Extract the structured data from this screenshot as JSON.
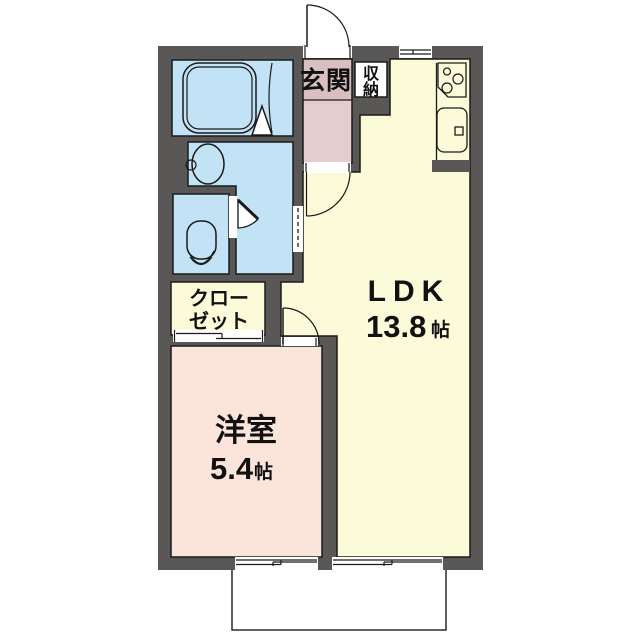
{
  "floorplan": {
    "type": "japanese-apartment-floorplan",
    "wall_color": "#5a5757",
    "outline_color": "#1b1b1b",
    "rooms": {
      "ldk": {
        "label": "LDK",
        "area_value": "13.8",
        "area_unit": "帖",
        "color": "#fbfad9"
      },
      "western_room": {
        "label": "洋室",
        "area_value": "5.4",
        "area_unit": "帖",
        "color": "#fbe5da"
      },
      "closet": {
        "lines": [
          "クロー",
          "ゼット"
        ],
        "color": "#fbfad9"
      },
      "genkan": {
        "label": "玄関",
        "color_upper": "#d9bfc0",
        "color_lower": "#e3cdcd"
      },
      "storage": {
        "chars": [
          "収",
          "納"
        ],
        "color": "#ffffff"
      },
      "bathroom": {
        "color": "#c2e2f6"
      },
      "washroom": {
        "color": "#c2e2f6"
      },
      "toilet_room": {
        "color": "#c2e2f6"
      },
      "balcony": {
        "color": "#ffffff"
      }
    },
    "fixtures": [
      "bathtub",
      "washbasin",
      "toilet",
      "stove-3-burner",
      "kitchen-sink",
      "folding-bath-door",
      "sliding-door",
      "sliding-windows",
      "entrance-door"
    ]
  }
}
